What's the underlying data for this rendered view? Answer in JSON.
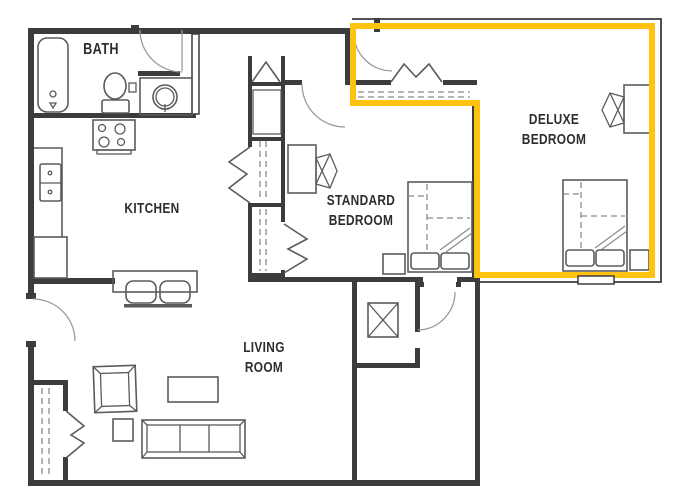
{
  "title": "Apartment floor plan with highlighted suite",
  "rooms": {
    "bath": {
      "label": "BATH"
    },
    "kitchen": {
      "label": "KITCHEN"
    },
    "standard_bedroom": {
      "label": "STANDARD\nBEDROOM"
    },
    "deluxe_bedroom": {
      "label": "DELUXE\nBEDROOM"
    },
    "living_room": {
      "label": "LIVING\nROOM"
    }
  },
  "highlight": {
    "target": "deluxe-bedroom-suite",
    "color": "#FFC20E"
  },
  "theme": {
    "wall": "#3b3c3e",
    "line": "#5a5b5e",
    "dash": "#8a8b8e",
    "text": "#2c2d30",
    "bg": "#ffffff"
  },
  "furniture_icons": [
    "bathtub-icon",
    "toilet-icon",
    "bathroom-sink-icon",
    "stove-icon",
    "kitchen-sink-icon",
    "breakfast-bar-icon",
    "bar-stool-icon",
    "bed-icon",
    "pillow-icon",
    "nightstand-icon",
    "desk-icon",
    "office-chair-icon",
    "sofa-icon",
    "armchair-icon",
    "coffee-table-icon",
    "side-table-icon",
    "utility-box-icon",
    "closet-icon",
    "door-arc-icon",
    "bifold-door-icon"
  ]
}
